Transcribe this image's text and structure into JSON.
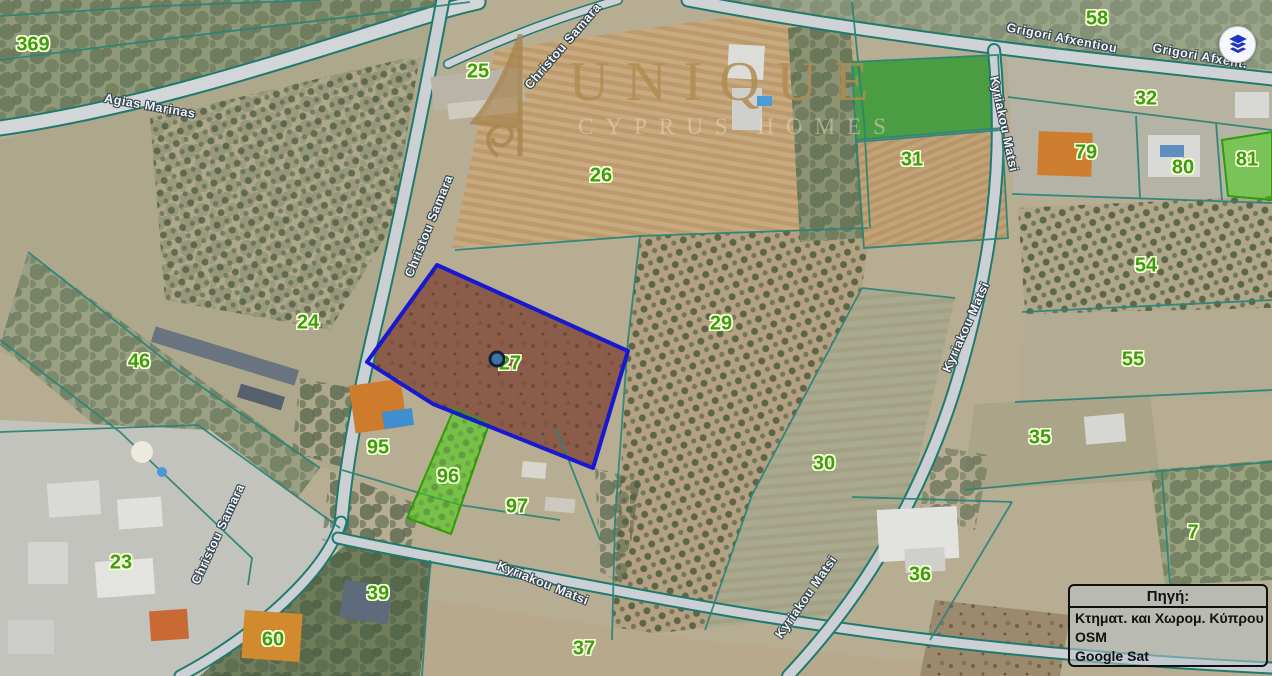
{
  "colors": {
    "parcel-label": "#3f9b10",
    "parcel-label-halo": "#f6ffd8",
    "street-label": "#f3f6f8",
    "street-label-halo": "#33434e",
    "boundary-teal": "#2a8477",
    "selected-blue": "#1718cf",
    "highlight-green": "#3fd40a",
    "marker-fill": "#41719f",
    "marker-ring": "#141e36",
    "watermark-gold": "#b08c52",
    "legend-text": "#111111"
  },
  "watermark": {
    "brand": "UNIQUE",
    "tagline": "CYPRUS HOMES"
  },
  "legend": {
    "title": "Πηγή:",
    "sources": [
      "Κτηματ. και Χωρομ. Κύπρου",
      "OSM",
      "Google Sat"
    ]
  },
  "selected_parcel": {
    "id": "27",
    "marker_x": 497,
    "marker_y": 359
  },
  "highlighted_parcels": [
    {
      "id": "27",
      "style": "blue-outline"
    },
    {
      "id": "96",
      "style": "green-fill"
    },
    {
      "id": "81",
      "style": "green-fill"
    }
  ],
  "parcel_labels": [
    {
      "id": "369",
      "x": 33,
      "y": 45
    },
    {
      "id": "25",
      "x": 478,
      "y": 72
    },
    {
      "id": "26",
      "x": 601,
      "y": 176
    },
    {
      "id": "58",
      "x": 1097,
      "y": 19
    },
    {
      "id": "32",
      "x": 1146,
      "y": 99
    },
    {
      "id": "79",
      "x": 1086,
      "y": 153
    },
    {
      "id": "80",
      "x": 1183,
      "y": 168
    },
    {
      "id": "81",
      "x": 1247,
      "y": 160
    },
    {
      "id": "31",
      "x": 912,
      "y": 160
    },
    {
      "id": "54",
      "x": 1146,
      "y": 266
    },
    {
      "id": "24",
      "x": 308,
      "y": 323
    },
    {
      "id": "46",
      "x": 139,
      "y": 362
    },
    {
      "id": "29",
      "x": 721,
      "y": 324
    },
    {
      "id": "55",
      "x": 1133,
      "y": 360
    },
    {
      "id": "27",
      "x": 510,
      "y": 364
    },
    {
      "id": "35",
      "x": 1040,
      "y": 438
    },
    {
      "id": "95",
      "x": 378,
      "y": 448
    },
    {
      "id": "96",
      "x": 448,
      "y": 477
    },
    {
      "id": "97",
      "x": 517,
      "y": 507
    },
    {
      "id": "30",
      "x": 824,
      "y": 464
    },
    {
      "id": "23",
      "x": 121,
      "y": 563
    },
    {
      "id": "7",
      "x": 1193,
      "y": 533
    },
    {
      "id": "36",
      "x": 920,
      "y": 575
    },
    {
      "id": "39",
      "x": 378,
      "y": 594
    },
    {
      "id": "60",
      "x": 273,
      "y": 640
    },
    {
      "id": "37",
      "x": 584,
      "y": 649
    }
  ],
  "street_labels": [
    {
      "name": "Agias Marinas",
      "x": 150,
      "y": 106,
      "rot": 10
    },
    {
      "name": "Christou Samara",
      "x": 563,
      "y": 46,
      "rot": -49
    },
    {
      "name": "Christou Samara",
      "x": 429,
      "y": 226,
      "rot": -68
    },
    {
      "name": "Christou Samara",
      "x": 218,
      "y": 534,
      "rot": -65
    },
    {
      "name": "Grigori Afxentiou",
      "x": 1062,
      "y": 38,
      "rot": 11
    },
    {
      "name": "Grigori Afxent.",
      "x": 1200,
      "y": 56,
      "rot": 10
    },
    {
      "name": "Kyriakou Matsi",
      "x": 1004,
      "y": 124,
      "rot": 78
    },
    {
      "name": "Kyriakou Matsi",
      "x": 966,
      "y": 327,
      "rot": -66
    },
    {
      "name": "Kyriakou Matsi",
      "x": 543,
      "y": 583,
      "rot": 22
    },
    {
      "name": "Kyriakou Matsi",
      "x": 806,
      "y": 597,
      "rot": -55
    }
  ]
}
